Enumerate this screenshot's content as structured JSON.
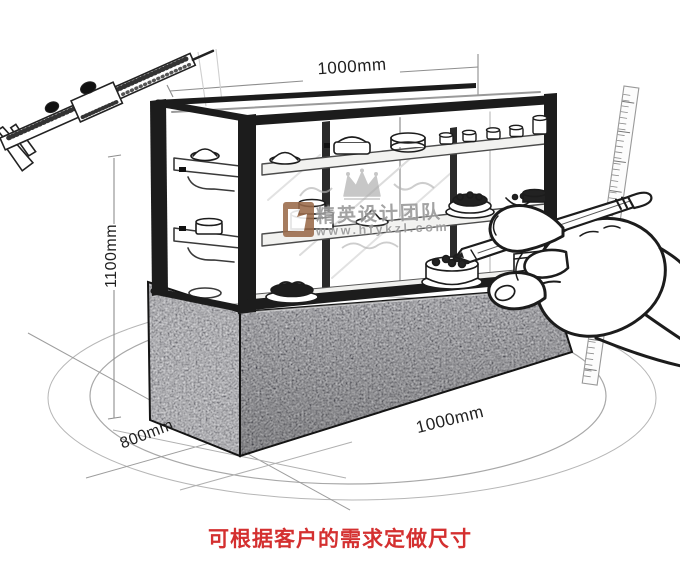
{
  "dimensions": {
    "top_width": "1000mm",
    "height": "1100mm",
    "depth": "800mm",
    "bottom_width": "1000mm"
  },
  "watermark": {
    "brand_text": "精英设计团队",
    "url": "www.hfykzl.com",
    "logo_color": "#9a6a4a",
    "text_color": "#9a9a9a"
  },
  "caption": {
    "text": "可根据客户的需求定做尺寸",
    "color": "#d43030"
  },
  "illustration": {
    "style": "black-and-white product sketch",
    "line_color": "#1c1c1c",
    "granite_color": "#5f5f5f",
    "figures": {
      "caliper": "vernier-caliper-sketch",
      "display_case": "cake-display-showcase-sketch",
      "hand": "hand-holding-pencil-sketch",
      "ruler": "vertical-ruler-sketch",
      "floor": "floor-ellipse-guides"
    }
  }
}
